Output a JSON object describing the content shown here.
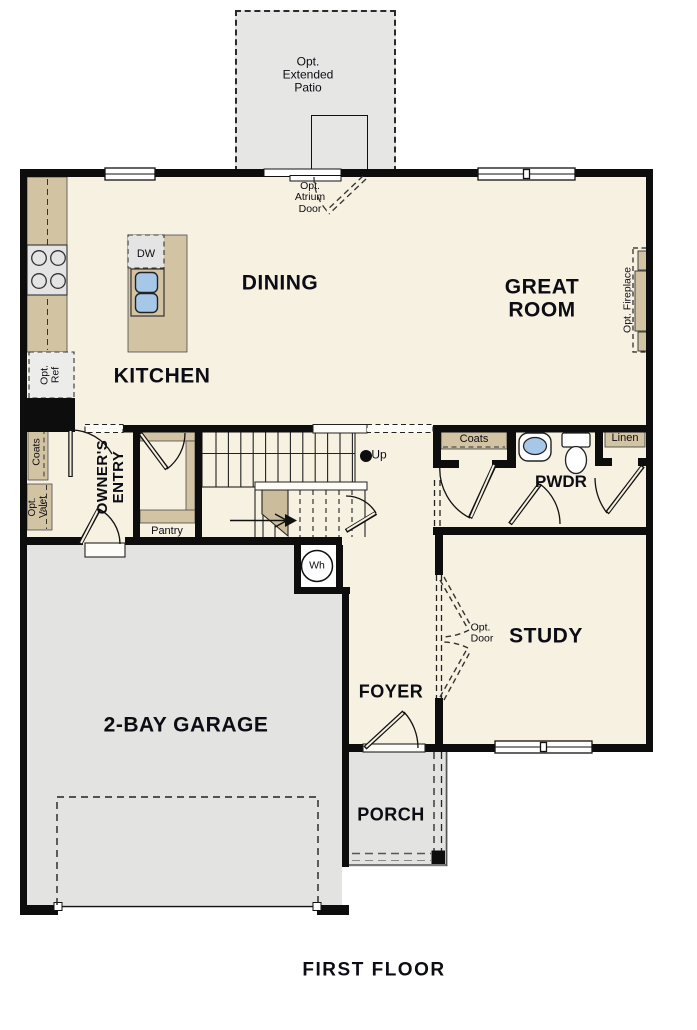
{
  "plan_title": "FIRST FLOOR",
  "rooms": {
    "dining": "DINING",
    "kitchen": "KITCHEN",
    "great_room": [
      "GREAT",
      "ROOM"
    ],
    "study": "STUDY",
    "foyer": "FOYER",
    "porch": "PORCH",
    "garage": "2-BAY GARAGE",
    "powder": "PWDR",
    "owners_entry": [
      "OWNER'S",
      "ENTRY"
    ]
  },
  "closets": {
    "coats_entry": "Coats",
    "coats_hall": "Coats",
    "linen": "Linen",
    "pantry": "Pantry"
  },
  "fixtures": {
    "dishwasher": "DW",
    "water_heater": "Wh",
    "stairs_up": "Up"
  },
  "options": {
    "extended_patio": [
      "Opt.",
      "Extended",
      "Patio"
    ],
    "atrium_door": [
      "Opt.",
      "Atrium",
      "Door"
    ],
    "refrigerator": [
      "Opt.",
      "Ref"
    ],
    "valet": [
      "Opt.",
      "Valet"
    ],
    "fireplace": "Opt. Fireplace",
    "study_door": [
      "Opt.",
      "Door"
    ]
  },
  "colors": {
    "floor": "#f7f1e2",
    "garage_floor": "#e3e3e1",
    "patio": "#e6e6e4",
    "wall": "#0d0d0d",
    "casework": "#d2c3a3",
    "appliance": "#e4e4e4",
    "sink": "#a7c7e8",
    "text": "#0c0c14"
  }
}
